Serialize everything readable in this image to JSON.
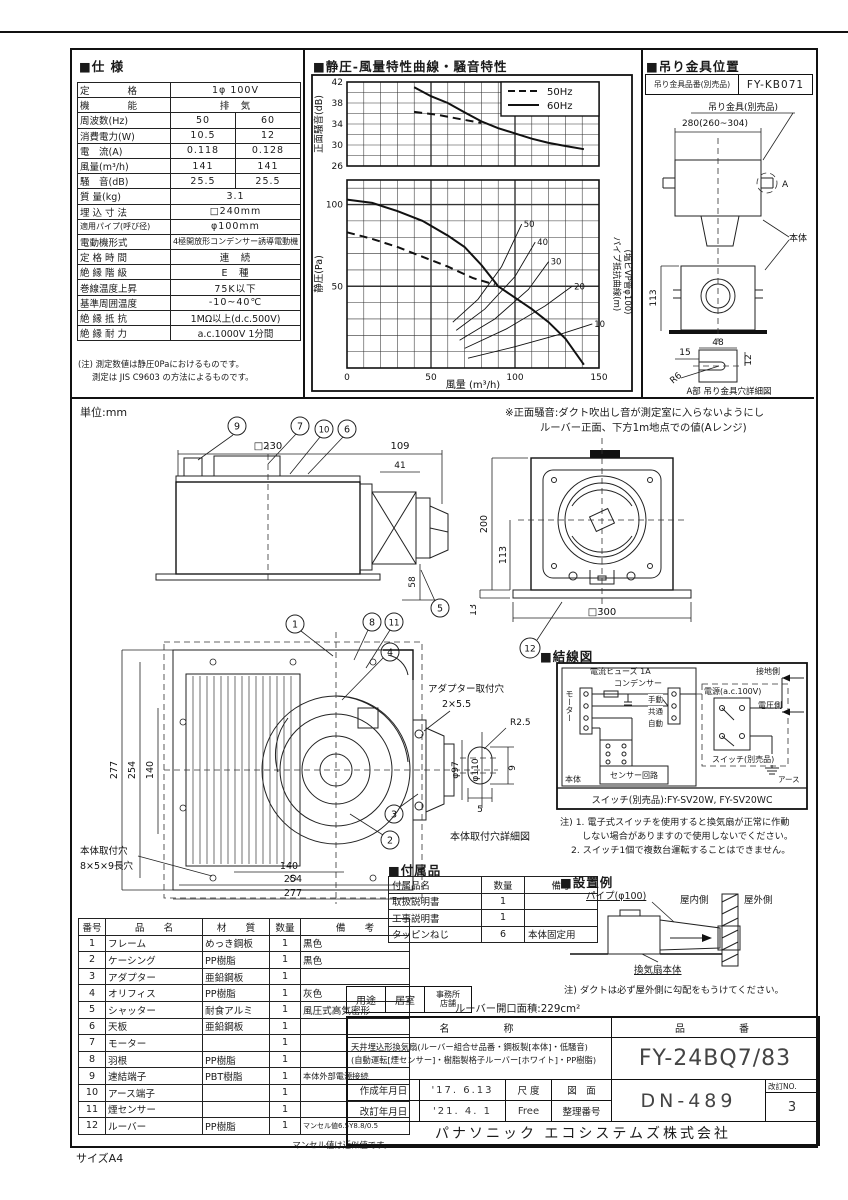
{
  "page": {
    "size_label": "サイズA4",
    "unit": "単位:mm",
    "top_rule": true
  },
  "spec": {
    "title": "■仕 様",
    "rows": [
      {
        "l": "定　　　　格",
        "v": "1φ 100V"
      },
      {
        "l": "機　　　　能",
        "v": "排　気"
      },
      {
        "l": "周波数(Hz)",
        "a": "50",
        "b": "60"
      },
      {
        "l": "消費電力(W)",
        "a": "10.5",
        "b": "12"
      },
      {
        "l": "電　流(A)",
        "a": "0.118",
        "b": "0.128"
      },
      {
        "l": "風量(m³/h)",
        "a": "141",
        "b": "141"
      },
      {
        "l": "騒　音(dB)",
        "a": "25.5",
        "b": "25.5"
      },
      {
        "l": "質 量(kg)",
        "v": "3.1"
      },
      {
        "l": "埋 込 寸 法",
        "v": "□240mm"
      },
      {
        "l": "適用パイプ(呼び径)",
        "v": "φ100mm"
      },
      {
        "l": "電動機形式",
        "v": "4極開放形コンデンサー誘導電動機"
      },
      {
        "l": "定 格 時 間",
        "v": "連　続"
      },
      {
        "l": "絶 縁 階 級",
        "v": "E　種"
      },
      {
        "l": "巻線温度上昇",
        "v": "75K以下"
      },
      {
        "l": "基準周囲温度",
        "v": "-10~40℃"
      },
      {
        "l": "絶 縁 抵 抗",
        "v": "1MΩ以上(d.c.500V)"
      },
      {
        "l": "絶 縁 耐 力",
        "v": "a.c.1000V 1分間"
      }
    ],
    "note1": "(注) 測定数値は静圧0Paにおけるものです。",
    "note2": "測定は JIS C9603 の方法によるものです。"
  },
  "chart": {
    "title": "■静圧-風量特性曲線・騒音特性"
  },
  "chart_data": [
    {
      "type": "line",
      "id": "noise",
      "ylabel": "正面騒音(dB)",
      "ylim": [
        26,
        42
      ],
      "grid_dy": 2,
      "yticks": [
        26,
        30,
        34,
        38,
        42
      ],
      "xlim": [
        0,
        150
      ],
      "grid_dx": 10,
      "xthick": [
        50,
        100
      ],
      "legend_pos": "top-right",
      "series": [
        {
          "name": "50Hz",
          "style": "dashed",
          "points": [
            [
              40,
              36.3
            ],
            [
              55,
              35.7
            ],
            [
              68,
              34.9
            ],
            [
              80,
              34.2
            ]
          ]
        },
        {
          "name": "60Hz",
          "style": "solid",
          "points": [
            [
              40,
              41
            ],
            [
              50,
              39.3
            ],
            [
              60,
              38
            ],
            [
              70,
              36.2
            ],
            [
              80,
              34.5
            ],
            [
              90,
              33.2
            ],
            [
              100,
              32.2
            ],
            [
              110,
              31.2
            ],
            [
              120,
              30.4
            ],
            [
              130,
              29.8
            ],
            [
              141,
              29.2
            ]
          ]
        }
      ]
    },
    {
      "type": "line",
      "id": "pq",
      "xlabel": "風量 (m³/h)",
      "ylabel": "静圧(Pa)",
      "right_label": "パイプ抵抗曲線(m)",
      "right_label2": "(塩ビVP管φ100)",
      "ylim": [
        0,
        115
      ],
      "grid_dy": 10,
      "yticks": [
        50,
        100
      ],
      "ythick": [
        50,
        100
      ],
      "xlim": [
        0,
        150
      ],
      "grid_dx": 10,
      "xticks": [
        0,
        50,
        100,
        150
      ],
      "xthick": [
        50,
        100
      ],
      "series": [
        {
          "name": "50Hz",
          "style": "dashed",
          "points": [
            [
              0,
              83
            ],
            [
              15,
              79
            ],
            [
              30,
              74
            ],
            [
              45,
              68
            ],
            [
              60,
              62
            ],
            [
              75,
              55
            ],
            [
              88,
              51
            ]
          ]
        },
        {
          "name": "60Hz",
          "style": "solid",
          "points": [
            [
              0,
              103
            ],
            [
              15,
              101
            ],
            [
              30,
              96
            ],
            [
              45,
              90
            ],
            [
              60,
              81
            ],
            [
              70,
              74
            ],
            [
              80,
              63
            ],
            [
              90,
              50
            ],
            [
              100,
              43
            ],
            [
              110,
              36
            ],
            [
              120,
              28
            ],
            [
              130,
              18
            ],
            [
              141,
              2
            ]
          ]
        },
        {
          "name": "pipe-50",
          "style": "thin",
          "label": "50",
          "points": [
            [
              63,
              28
            ],
            [
              78,
              42
            ],
            [
              92,
              62
            ],
            [
              104,
              88
            ]
          ]
        },
        {
          "name": "pipe-40",
          "style": "thin",
          "label": "40",
          "points": [
            [
              65,
              23
            ],
            [
              82,
              36
            ],
            [
              100,
              56
            ],
            [
              112,
              77
            ]
          ]
        },
        {
          "name": "pipe-30",
          "style": "thin",
          "label": "30",
          "points": [
            [
              67,
              17
            ],
            [
              88,
              30
            ],
            [
              108,
              48
            ],
            [
              120,
              65
            ]
          ]
        },
        {
          "name": "pipe-20",
          "style": "thin",
          "label": "20",
          "points": [
            [
              70,
              12
            ],
            [
              95,
              24
            ],
            [
              118,
              38
            ],
            [
              134,
              50
            ]
          ]
        },
        {
          "name": "pipe-10",
          "style": "thin",
          "label": "10",
          "points": [
            [
              72,
              6
            ],
            [
              100,
              13
            ],
            [
              128,
              21
            ],
            [
              146,
              27
            ]
          ]
        }
      ]
    }
  ],
  "bracket": {
    "title": "■吊り金具位置",
    "part_label": "吊り金具品番(別売品)",
    "part_no": "FY-KB071",
    "item_label": "吊り金具(別売品)",
    "dim_span": "280(260~304)",
    "label_a": "A",
    "body_label": "本体",
    "dim_113": "113",
    "dim_48": "48",
    "dim_15": "15",
    "dim_12": "12",
    "r6": "R6",
    "caption": "A部 吊り金具穴詳細図"
  },
  "note_front": {
    "line1": "※正面騒音:ダクト吹出し音が測定室に入らないようにし",
    "line2": "ルーバー正面、下方1m地点での値(Aレンジ)"
  },
  "side": {
    "d230": "□230",
    "d109": "109",
    "d41": "41",
    "d58": "58",
    "c9": "9",
    "c7": "7",
    "c10": "10",
    "c6": "6",
    "c5": "5"
  },
  "rear": {
    "d200": "200",
    "d113": "113",
    "d300": "□300",
    "d13": "13",
    "c12": "12"
  },
  "bottomview": {
    "d277": "277",
    "d254": "254",
    "d140": "140",
    "d140b": "140",
    "d254b": "254",
    "d277b": "277",
    "d97": "φ97",
    "d110": "φ110",
    "c1": "1",
    "c8": "8",
    "c11": "11",
    "c4": "4",
    "c3": "3",
    "c2": "2",
    "adapter_hole1": "アダプター取付穴",
    "adapter_hole2": "2×5.5",
    "body_hole1": "本体取付穴",
    "body_hole2": "8×5×9長穴",
    "r25": "R2.5",
    "d9": "9",
    "d5": "5",
    "caption": "本体取付穴詳細図"
  },
  "wiring": {
    "title": "■結線図",
    "fuse": "電流ヒューズ 1A",
    "capacitor": "コンデンサー",
    "motor": "モーター",
    "manual": "手動",
    "common": "共通",
    "auto": "自動",
    "sensor": "センサー回路",
    "body": "本体",
    "power": "電源(a.c.100V)",
    "ground_side": "接地側",
    "volt_side": "電圧側",
    "switch": "スイッチ(別売品)",
    "earth": "アース",
    "switch_models": "スイッチ(別売品):FY-SV20W, FY-SV20WC",
    "note1": "注) 1. 電子式スイッチを使用すると換気扇が正常に作動",
    "note2": "しない場合がありますので使用しないでください。",
    "note3": "2. スイッチ1個で複数台運転することはできません。"
  },
  "accessories": {
    "title": "■付属品",
    "h1": "付属品名",
    "h2": "数量",
    "h3": "備考",
    "rows": [
      {
        "name": "取扱説明書",
        "qty": "1",
        "note": ""
      },
      {
        "name": "工事説明書",
        "qty": "1",
        "note": ""
      },
      {
        "name": "タッピンねじ",
        "qty": "6",
        "note": "本体固定用"
      }
    ]
  },
  "install": {
    "title": "■設置例",
    "pipe": "パイプ(φ100)",
    "indoor": "屋内側",
    "outdoor": "屋外側",
    "fan_body": "換気扇本体",
    "note": "注) ダクトは必ず屋外側に勾配をもうけてください。"
  },
  "parts": {
    "h_no": "番号",
    "h_name": "品　　名",
    "h_mat": "材　　質",
    "h_qty": "数量",
    "h_note": "備　　考",
    "rows": [
      {
        "no": "1",
        "name": "フレーム",
        "mat": "めっき鋼板",
        "qty": "1",
        "note": "黒色"
      },
      {
        "no": "2",
        "name": "ケーシング",
        "mat": "PP樹脂",
        "qty": "1",
        "note": "黒色"
      },
      {
        "no": "3",
        "name": "アダプター",
        "mat": "亜鉛鋼板",
        "qty": "1",
        "note": ""
      },
      {
        "no": "4",
        "name": "オリフィス",
        "mat": "PP樹脂",
        "qty": "1",
        "note": "灰色"
      },
      {
        "no": "5",
        "name": "シャッター",
        "mat": "耐食アルミ",
        "qty": "1",
        "note": "風圧式高気密形"
      },
      {
        "no": "6",
        "name": "天板",
        "mat": "亜鉛鋼板",
        "qty": "1",
        "note": ""
      },
      {
        "no": "7",
        "name": "モーター",
        "mat": "",
        "qty": "1",
        "note": ""
      },
      {
        "no": "8",
        "name": "羽根",
        "mat": "PP樹脂",
        "qty": "1",
        "note": ""
      },
      {
        "no": "9",
        "name": "速結端子",
        "mat": "PBT樹脂",
        "qty": "1",
        "note": "本体外部電源接続"
      },
      {
        "no": "10",
        "name": "アース端子",
        "mat": "",
        "qty": "1",
        "note": ""
      },
      {
        "no": "11",
        "name": "煙センサー",
        "mat": "",
        "qty": "1",
        "note": ""
      },
      {
        "no": "12",
        "name": "ルーバー",
        "mat": "PP樹脂",
        "qty": "1",
        "note": "マンセル値6.5Y8.8/0.5"
      }
    ],
    "footnote": "マンセル値は近似値です。"
  },
  "usage": {
    "label": "用途",
    "v1": "居室",
    "v2a": "事務所",
    "v2b": "店舗",
    "louver_area": "ルーバー開口面積:229cm²"
  },
  "titleblock": {
    "name_header": "名　　　称",
    "no_header": "品　　　番",
    "name_line1": "天井埋込形換気扇(ルーバー組合せ品番・鋼板製[本体]・低騒音)",
    "name_line2": "(自動運転[煙センサー]・樹脂製格子ルーバー[ホワイト]・PP樹脂)",
    "part_no": "FY-24BQ7/83",
    "created_label": "作成年月日",
    "created": "'17. 6.13",
    "revised_label": "改訂年月日",
    "revised": "'21. 4. 1",
    "scale_label": "尺 度",
    "scale": "Free",
    "dwg_label1": "図　面",
    "dwg_label2": "整理番号",
    "dwg_no": "DN-489",
    "rev_label": "改訂NO.",
    "rev_no": "3",
    "company": "パナソニック エコシステムズ株式会社"
  }
}
